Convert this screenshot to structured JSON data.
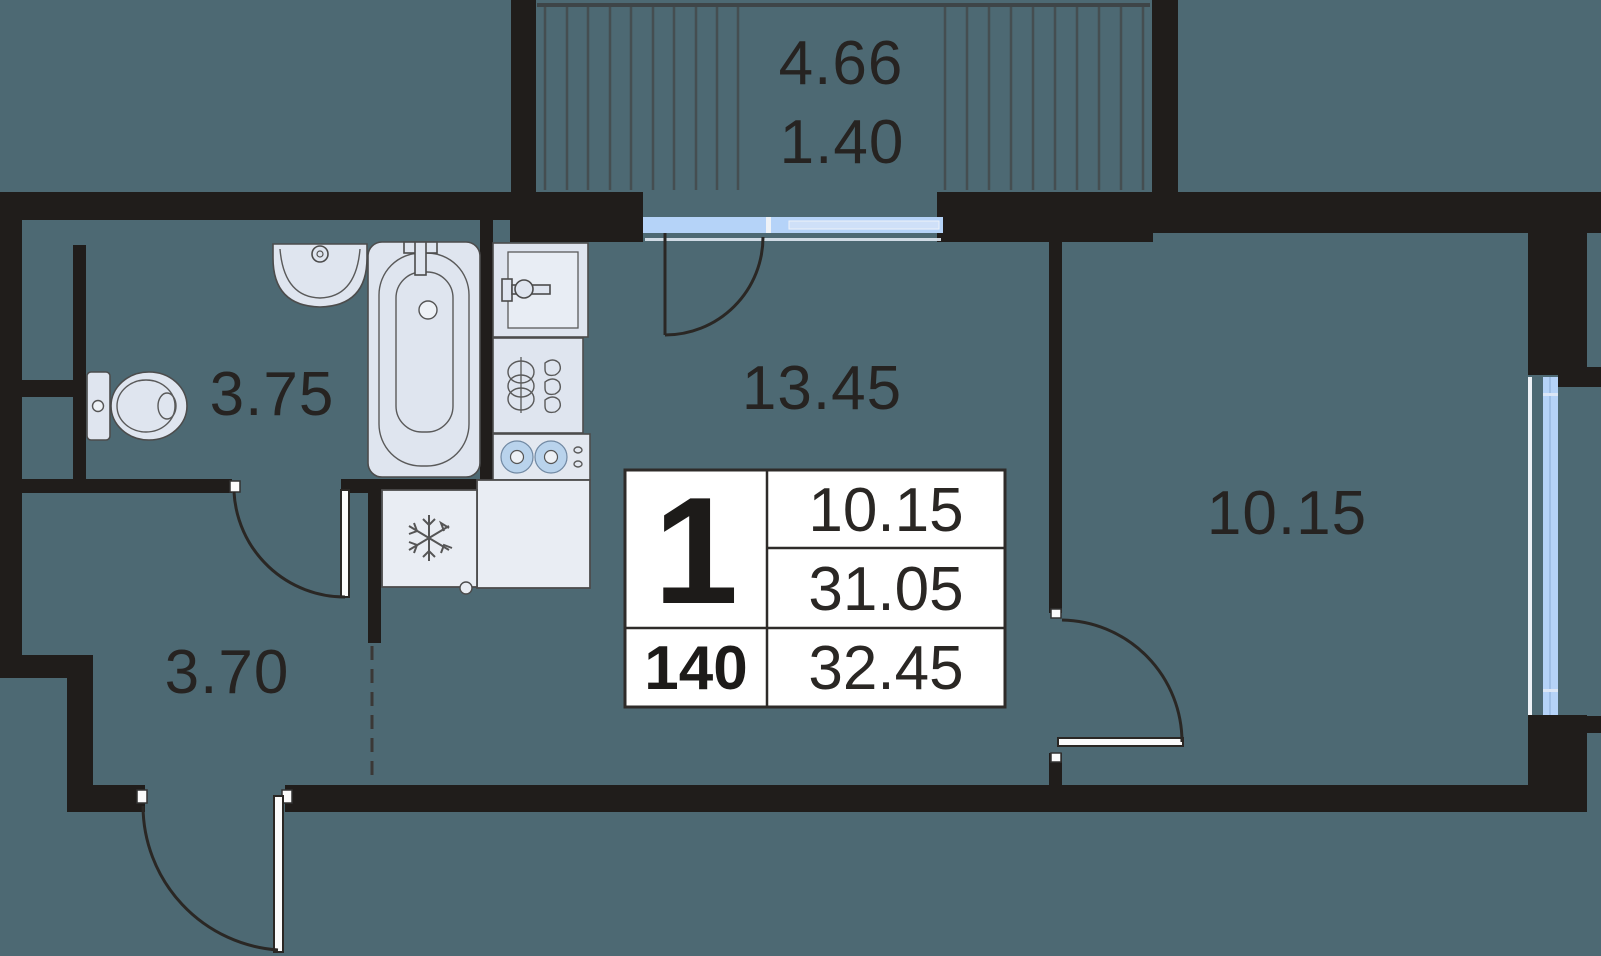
{
  "floorplan": {
    "balcony": {
      "area": "4.66",
      "area_reduced": "1.40"
    },
    "rooms": {
      "bathroom": "3.75",
      "kitchen_living": "13.45",
      "hallway": "3.70",
      "bedroom": "10.15"
    },
    "info_table": {
      "rooms_count": "1",
      "living_area": "10.15",
      "area_without_balcony": "31.05",
      "unit_number": "140",
      "total_area": "32.45"
    },
    "colors": {
      "background": "#4d6973",
      "wall": "#201d1b",
      "fixture_fill": "#dfe5ef",
      "window_blue": "#b5d3f8",
      "table_bg": "#ffffff",
      "text": "#262321"
    }
  }
}
